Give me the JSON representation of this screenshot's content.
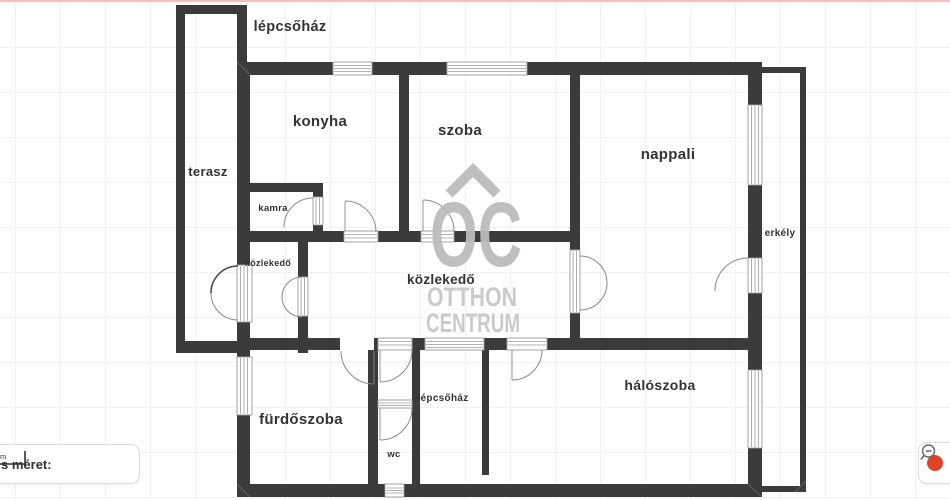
{
  "labels": {
    "lepcsohaz_top": "lépcsőház",
    "konyha": "konyha",
    "szoba": "szoba",
    "nappali": "nappali",
    "terasz": "terasz",
    "kamra": "kamra",
    "kozlekedo_entry": "közlekedő",
    "kozlekedo_hall": "közlekedő",
    "erkely": "erkély",
    "furdoszoba": "fürdőszoba",
    "lepcsohaz_bottom": "lépcsőház",
    "wc": "wc",
    "haloszoba": "hálószoba"
  },
  "watermark": {
    "logo": "OC",
    "line1": "OTTHON",
    "line2": "CENTRUM"
  },
  "scalebar": {
    "label": "s méret:",
    "unit": "1m"
  },
  "controls": {
    "zoom_out_icon": "magnifier-minus-icon",
    "red_button_color": "#de4328"
  },
  "colors": {
    "wall": "#3b3b3b",
    "watermark": "#bcbcbc",
    "grid": "#f1f1f1",
    "top_line": "#f0c4bb",
    "accent_red": "#de4328"
  }
}
